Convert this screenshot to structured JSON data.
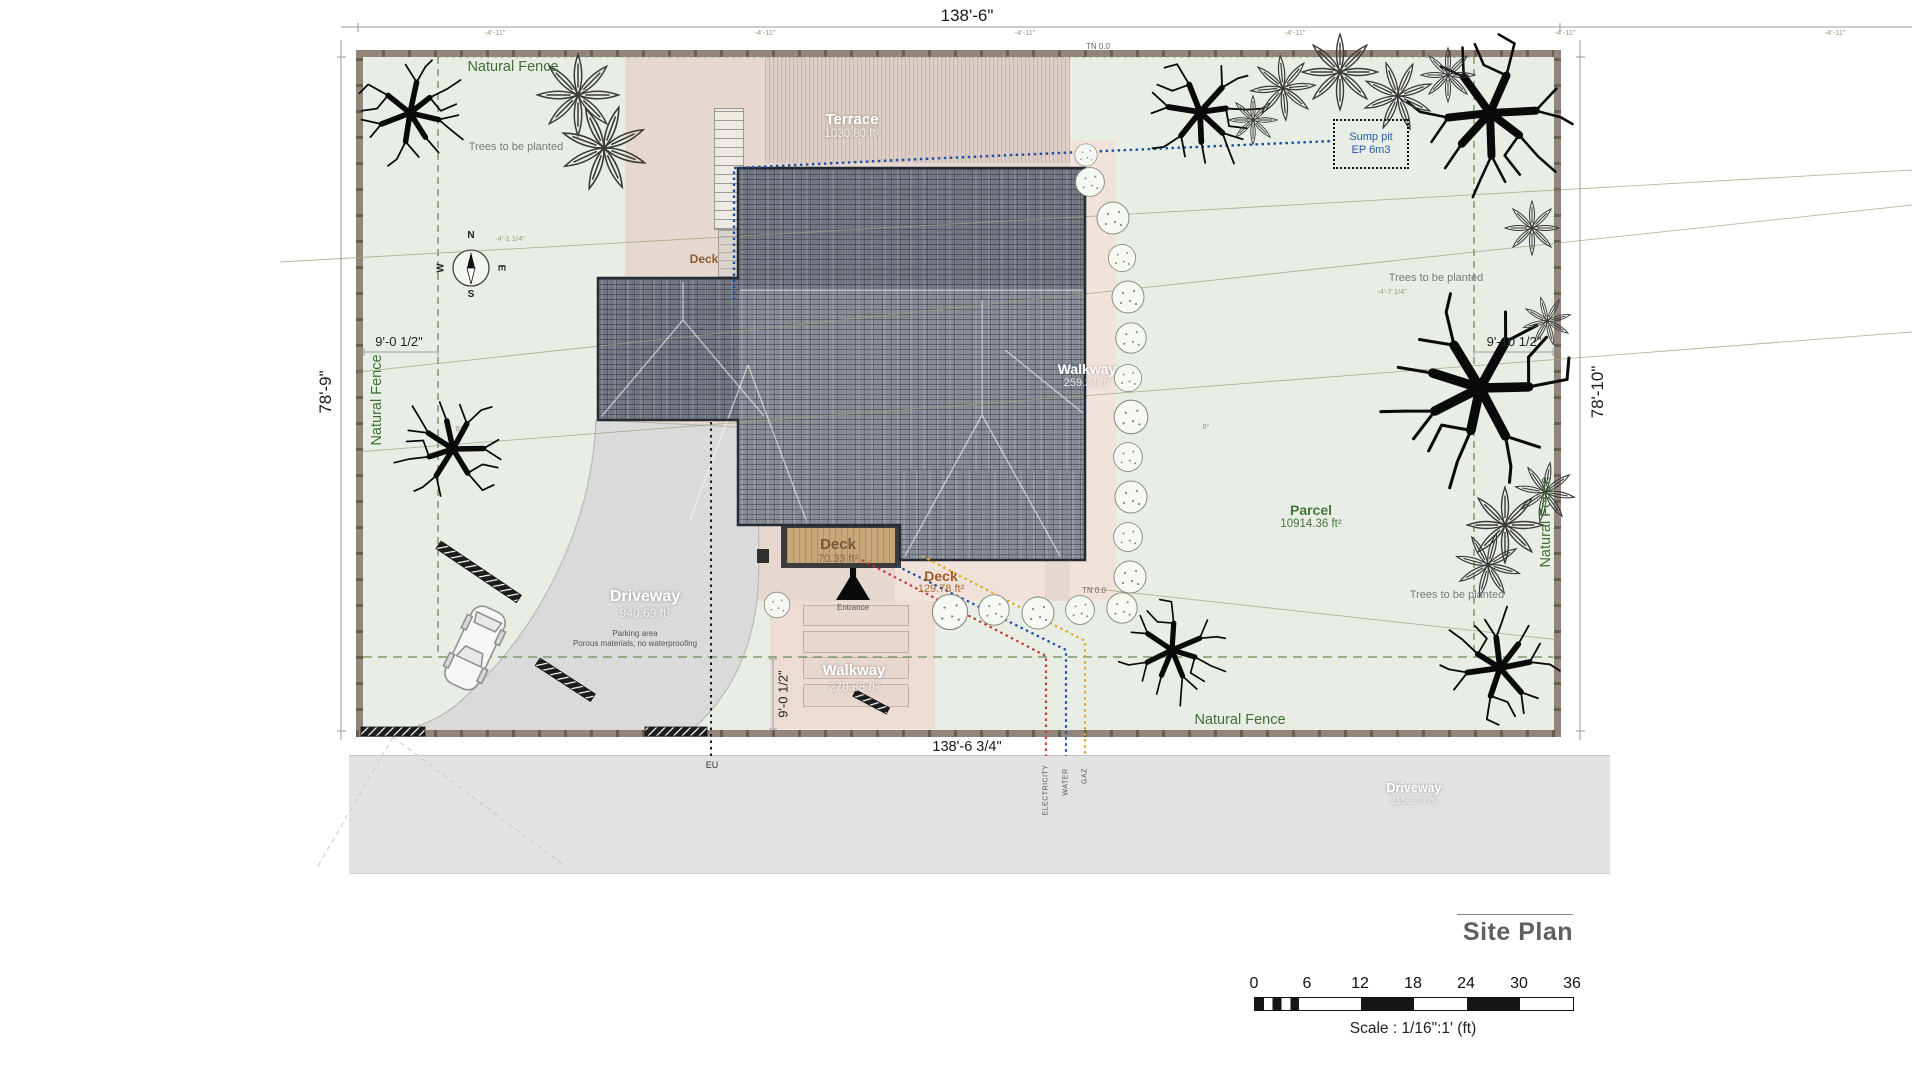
{
  "canvas": {
    "bg": "#ffffff",
    "lawn": "#e8eee6",
    "beige": "#e6d8d0",
    "roof": "#848a95",
    "accent_green": "#3f6f35",
    "accent_blue": "#1e4fa0",
    "accent_red": "#c43b31",
    "accent_yellow": "#ddaa22"
  },
  "dimensions": {
    "top": "138'-6\"",
    "bottom": "138'-6 3/4\"",
    "left": "78'-9\"",
    "right": "78'-10\"",
    "tick": "-4'-11\"",
    "setback_left": "9'-0 1/2\"",
    "setback_right": "9'-10 1/2\"",
    "setback_bottom": "9'-0 1/2\"",
    "offset_left": "-4'-1 1/4\"",
    "offset_right": "-4'-7 1/4\"",
    "angle_left": "0°",
    "angle_right": "0°"
  },
  "labels": {
    "natural_fence": "Natural Fence",
    "trees_note": "Trees to be planted",
    "tn": "TN 0.0",
    "eu": "EU",
    "entrance": "Entrance"
  },
  "areas": {
    "terrace": {
      "name": "Terrace",
      "area": "1030.80 ft²"
    },
    "deck_upper": {
      "name": "Deck"
    },
    "deck_main": {
      "name": "Deck",
      "area": "70.33 ft²"
    },
    "deck_south": {
      "name": "Deck",
      "area": "129.78 ft²"
    },
    "walkway_east": {
      "name": "Walkway",
      "area": "259.24 ft²"
    },
    "walkway_south": {
      "name": "Walkway",
      "area": "278.88 ft²"
    },
    "driveway": {
      "name": "Driveway",
      "area": "940.69 ft²"
    },
    "road": {
      "name": "Driveway",
      "area": "2156.73 ft²"
    },
    "parcel": {
      "name": "Parcel",
      "area": "10914.36 ft²"
    }
  },
  "callouts": {
    "sump_line1": "Sump pit",
    "sump_line2": "EP 6m3",
    "parking_line1": "Parking area",
    "parking_line2": "Porous materials, no waterproofing"
  },
  "utilities": {
    "electricity": "ELECTRICITY",
    "water": "WATER",
    "gas": "GAZ"
  },
  "compass": {
    "n": "N",
    "s": "S",
    "e": "E",
    "w": "W"
  },
  "title_block": {
    "title": "Site Plan",
    "scale_text": "Scale : 1/16\":1' (ft)",
    "ticks": [
      "0",
      "6",
      "12",
      "18",
      "24",
      "30",
      "36"
    ]
  }
}
